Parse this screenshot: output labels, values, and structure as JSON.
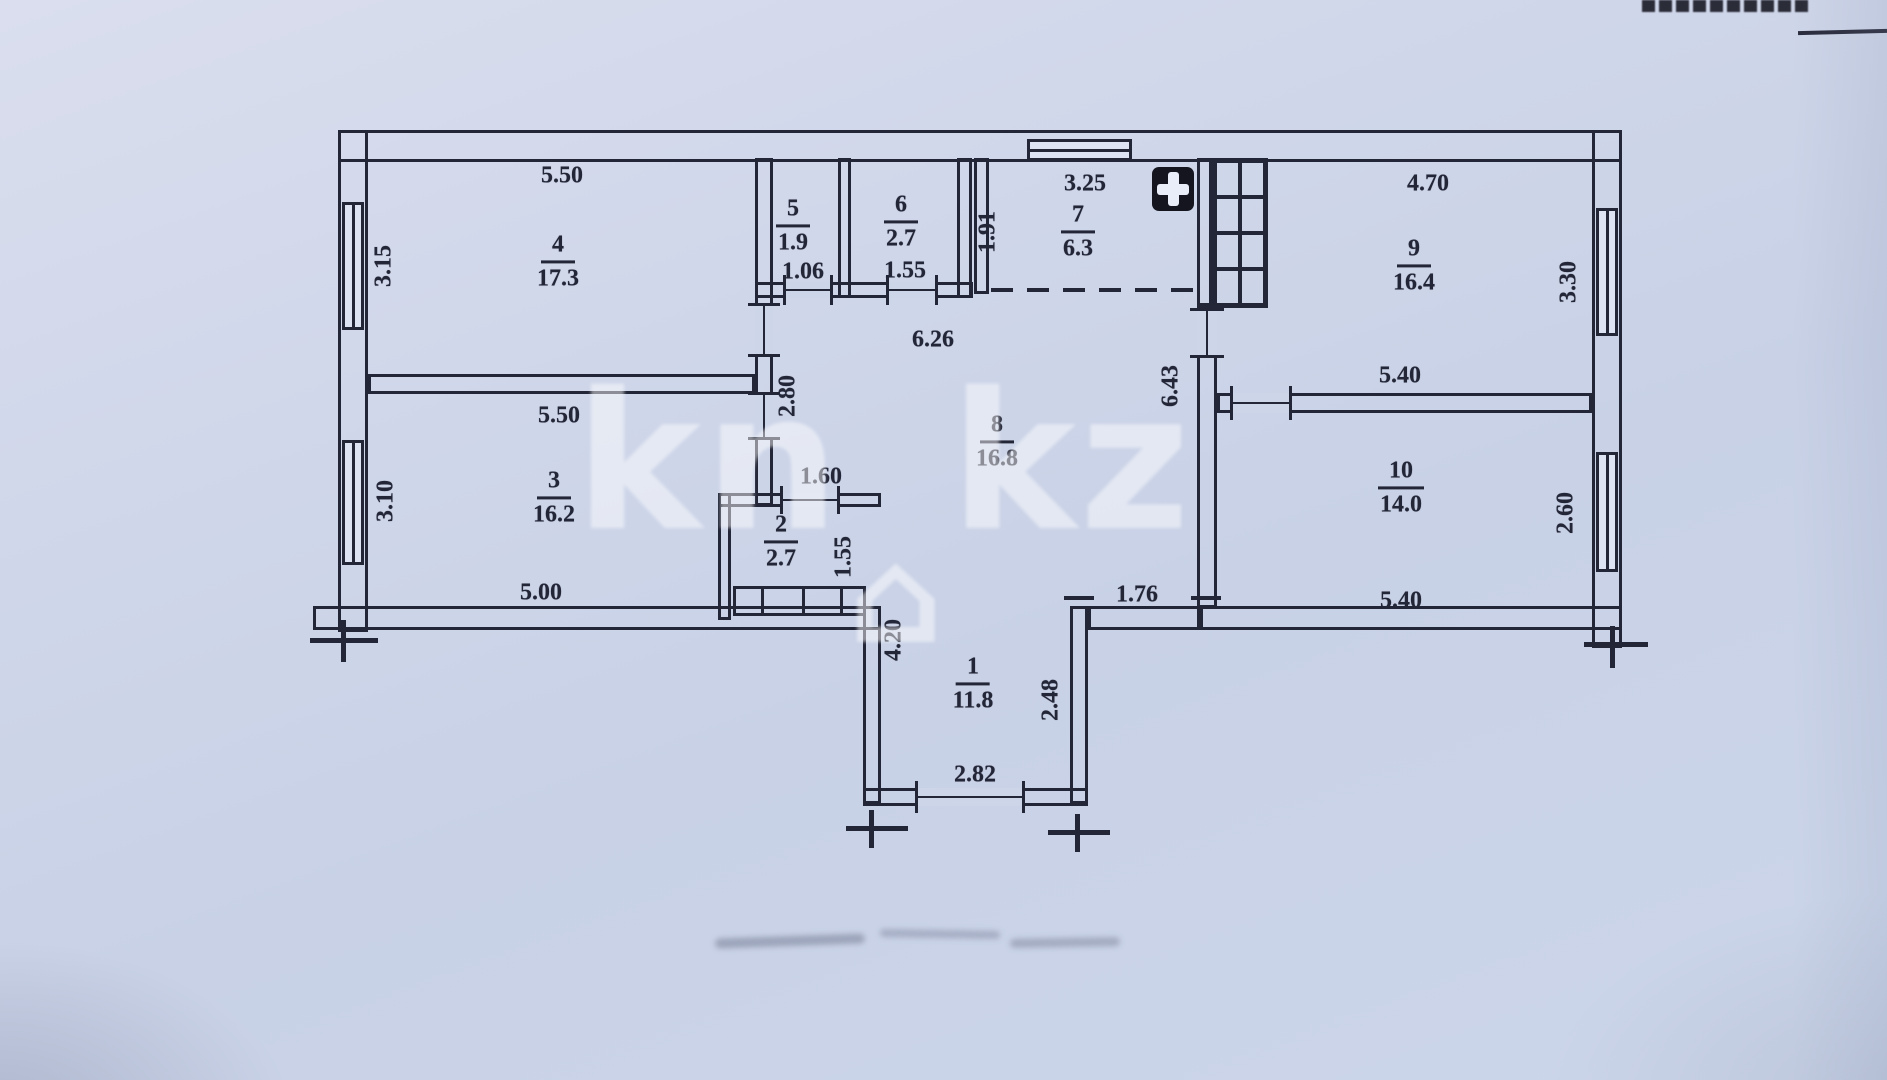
{
  "colors": {
    "paper": "#cdd5e9",
    "ink": "#232637",
    "watermark": "rgba(255,255,255,0.48)"
  },
  "watermark": {
    "left": "kn",
    "house": "⌂",
    "right": "kz"
  },
  "rooms": {
    "r1": {
      "num": "1",
      "area": "11.8"
    },
    "r2": {
      "num": "2",
      "area": "2.7"
    },
    "r3": {
      "num": "3",
      "area": "16.2"
    },
    "r4": {
      "num": "4",
      "area": "17.3"
    },
    "r5": {
      "num": "5",
      "area": "1.9"
    },
    "r6": {
      "num": "6",
      "area": "2.7"
    },
    "r7": {
      "num": "7",
      "area": "6.3"
    },
    "r8": {
      "num": "8",
      "area": "16.8"
    },
    "r9": {
      "num": "9",
      "area": "16.4"
    },
    "r10": {
      "num": "10",
      "area": "14.0"
    }
  },
  "dims": {
    "r4_top": "5.50",
    "r4_left": "3.15",
    "r3_top": "5.50",
    "r3_left": "3.10",
    "r3_bottom": "5.00",
    "r5_bottom": "1.06",
    "r6_bottom": "1.55",
    "r7_left": "1.91",
    "r7_top": "3.25",
    "r9_top": "4.70",
    "r9_right": "3.30",
    "hall_top": "6.26",
    "hall_left": "2.80",
    "hall_right": "6.43",
    "r10_top": "5.40",
    "r10_right": "2.60",
    "r10_bottom": "5.40",
    "lobby": "1.60",
    "r2_right": "1.55",
    "r1_left": "4.20",
    "r1_right": "2.48",
    "r1_bottom": "2.82",
    "r1_top": "1.76"
  }
}
